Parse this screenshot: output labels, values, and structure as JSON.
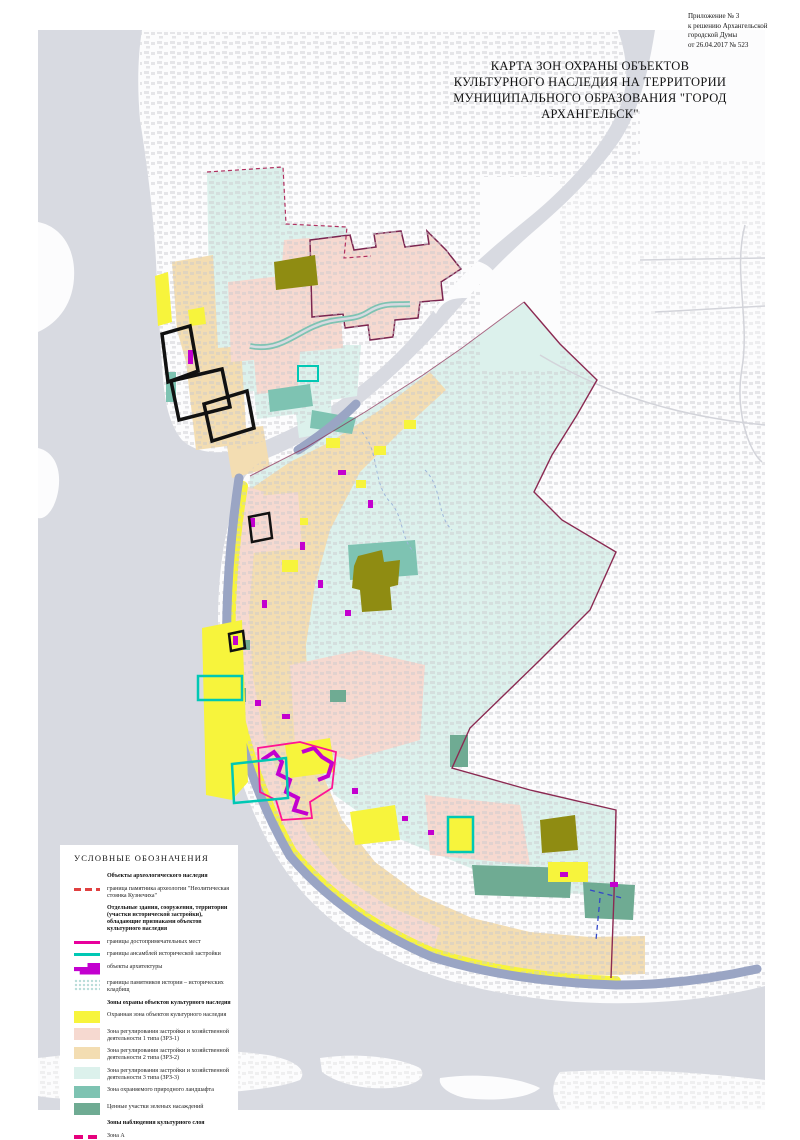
{
  "annotation": {
    "line1": "Приложение № 3",
    "line2": "к решению Архангельской",
    "line3": "городской Думы",
    "line4": "от 26.04.2017 № 523"
  },
  "title": {
    "line1": "КАРТА ЗОН ОХРАНЫ ОБЪЕКТОВ",
    "line2": "КУЛЬТУРНОГО НАСЛЕДИЯ НА ТЕРРИТОРИИ",
    "line3": "МУНИЦИПАЛЬНОГО ОБРАЗОВАНИЯ \"ГОРОД АРХАНГЕЛЬСК\""
  },
  "legend": {
    "title": "УСЛОВНЫЕ ОБОЗНАЧЕНИЯ",
    "items": [
      {
        "bold": true,
        "swatch": "none",
        "label": "Объекты археологического наследия"
      },
      {
        "bold": false,
        "swatch": "dash-red",
        "label": "граница памятника археологии \"Неолитическая стоянка Кузнечиха\""
      },
      {
        "bold": true,
        "swatch": "none",
        "label": "Отдельные здания, сооружения, территории (участки исторической застройки), обладающие признаками объектов культурного наследия"
      },
      {
        "bold": false,
        "swatch": "line-magenta",
        "label": "границы достопримечательных мест"
      },
      {
        "bold": false,
        "swatch": "line-teal",
        "label": "границы ансамблей исторической застройки"
      },
      {
        "bold": false,
        "swatch": "blob-magenta",
        "label": "объекты архитектуры"
      },
      {
        "bold": false,
        "swatch": "dots",
        "label": "границы памятников истории – исторических кладбищ"
      },
      {
        "bold": true,
        "swatch": "none",
        "label": "Зоны охраны объектов культурного наследия"
      },
      {
        "bold": false,
        "swatch": "fill-yellow",
        "label": "Охранная зона объектов культурного наследия"
      },
      {
        "bold": false,
        "swatch": "fill-pink",
        "label": "Зона регулирования застройки и хозяйственной деятельности 1 типа (ЗРЗ-1)"
      },
      {
        "bold": false,
        "swatch": "fill-tan",
        "label": "Зона регулирования застройки и хозяйственной деятельности 2 типа (ЗРЗ-2)"
      },
      {
        "bold": false,
        "swatch": "fill-cyan",
        "label": "Зона регулирования застройки и хозяйственной деятельности 3 типа (ЗРЗ-3)"
      },
      {
        "bold": false,
        "swatch": "fill-teal",
        "label": "Зона охраняемого природного ландшафта"
      },
      {
        "bold": false,
        "swatch": "fill-sage",
        "label": "Ценные участки зеленых насаждений"
      },
      {
        "bold": true,
        "swatch": "none",
        "label": "Зоны наблюдения культурного слоя"
      },
      {
        "bold": false,
        "swatch": "dash-zoneA",
        "label": "Зона А"
      },
      {
        "bold": false,
        "swatch": "dash-zoneB",
        "label": "Зона Б"
      },
      {
        "bold": false,
        "swatch": "dash-zoneV",
        "label": "Зона В"
      }
    ]
  },
  "colors": {
    "water": "#d8dae1",
    "water_dark": "#9aa5c4",
    "land": "#fcfcfd",
    "street": "#c9c9cf",
    "zone_yellow": "#f7f43c",
    "zone_pink": "#f6d9d0",
    "zone_tan": "#f3ddb2",
    "zone_cyan": "#dcf1ec",
    "teal": "#7ec3b2",
    "sage": "#6fab93",
    "olive": "#8f8c12",
    "magenta_obj": "#c300cf",
    "line_ensemble": "#00c8b4",
    "line_place": "#e8009c",
    "line_arch": "#e04040",
    "zoneA": "#e6007d",
    "zoneB": "#e8ea00",
    "zoneV": "#3347c9",
    "boundary": "#8b2a52",
    "dots": "#b8dcd8",
    "outline_black": "#111111"
  }
}
